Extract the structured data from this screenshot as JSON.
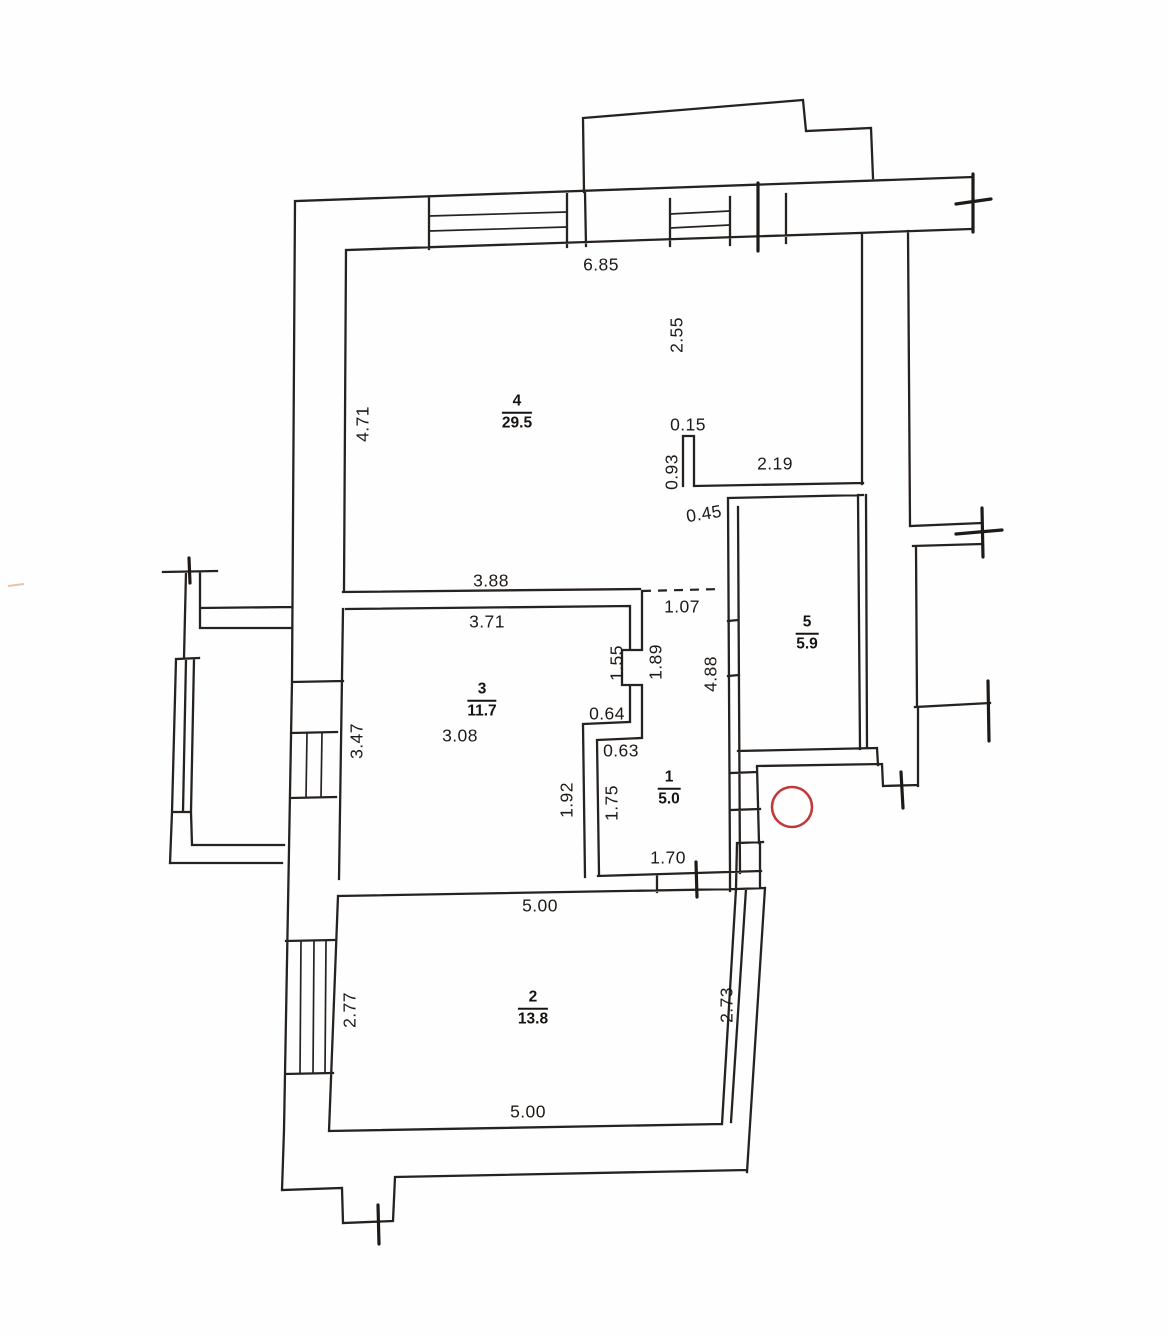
{
  "document": {
    "type": "apartment floor plan (scanned technical drawing)",
    "units": "meters"
  },
  "colors": {
    "line": "#262220",
    "stamp_red": "#c13a3a",
    "background": "#fefefe"
  },
  "rooms": {
    "r1": {
      "number": "1",
      "area": "5.0"
    },
    "r2": {
      "number": "2",
      "area": "13.8"
    },
    "r3": {
      "number": "3",
      "area": "11.7"
    },
    "r4": {
      "number": "4",
      "area": "29.5"
    },
    "r5": {
      "number": "5",
      "area": "5.9"
    }
  },
  "dims": {
    "d_685": "6.85",
    "d_255": "2.55",
    "d_471": "4.71",
    "d_015": "0.15",
    "d_093": "0.93",
    "d_219": "2.19",
    "d_045": "0.45",
    "d_388": "3.88",
    "d_107": "1.07",
    "d_371": "3.71",
    "d_155": "1.55",
    "d_189": "1.89",
    "d_488": "4.88",
    "d_347": "3.47",
    "d_064": "0.64",
    "d_308": "3.08",
    "d_063": "0.63",
    "d_192": "1.92",
    "d_175": "1.75",
    "d_170": "1.70",
    "d_500_top": "5.00",
    "d_500_bottom": "5.00",
    "d_277": "2.77",
    "d_273": "2.73"
  },
  "stamp": {
    "shape": "circle",
    "color": "#c13a3a"
  }
}
